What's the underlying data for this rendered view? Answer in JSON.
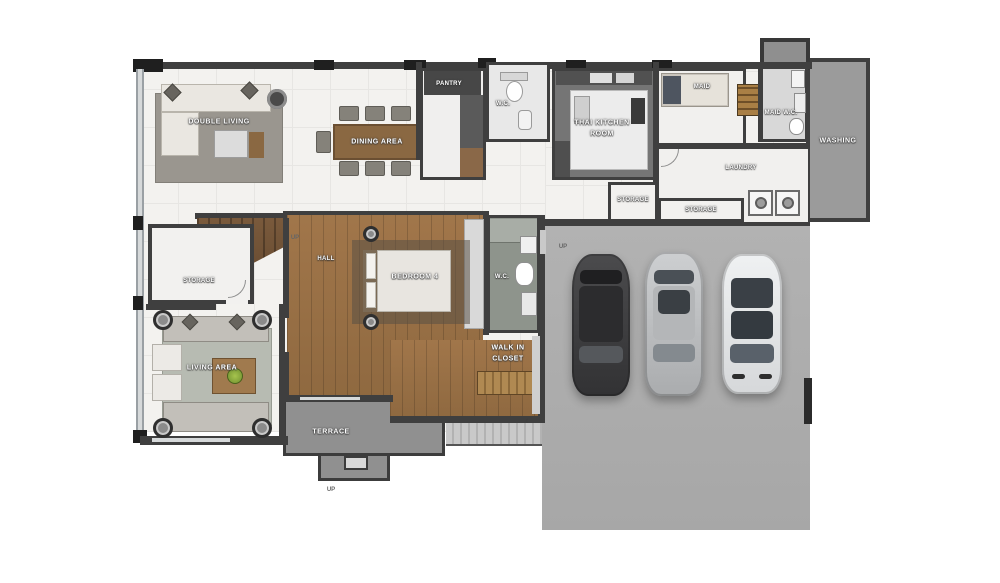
{
  "title": "house-ground-floor-plan",
  "colors": {
    "wall": "#3f3f3f",
    "marble_floor": "#f3f2ef",
    "wood_floor": "#9b7046",
    "stair_wood": "#7a5a3c",
    "garage_concrete": "#acacac",
    "terrace_concrete": "#909090",
    "washing_floor": "#9b9b9b",
    "thai_kitchen_floor": "#757575",
    "label_text": "#ffffff",
    "car_dark": "#3f4042",
    "car_silver": "#c6c8ca",
    "car_white": "#ebedee"
  },
  "rooms": {
    "double_living": {
      "label": "DOUBLE LIVING"
    },
    "dining_area": {
      "label": "DINING AREA"
    },
    "pantry": {
      "label": "PANTRY"
    },
    "wc_top": {
      "label": "W.C."
    },
    "thai_kitchen": {
      "line1": "THAI KITCHEN",
      "line2": "ROOM"
    },
    "maid": {
      "label": "MAID"
    },
    "maid_wc": {
      "label": "MAID W.C."
    },
    "washing": {
      "label": "WASHING"
    },
    "laundry": {
      "label": "LAUNDRY"
    },
    "storage_kitchen": {
      "label": "STORAGE"
    },
    "storage_laundry": {
      "label": "STORAGE"
    },
    "hall": {
      "label": "HALL"
    },
    "storage_hall": {
      "label": "STORAGE"
    },
    "bedroom4": {
      "label": "BEDROOM 4"
    },
    "wc_bedroom": {
      "label": "W.C."
    },
    "walk_in_closet": {
      "line1": "WALK IN",
      "line2": "CLOSET"
    },
    "living_area": {
      "label": "LIVING AREA"
    },
    "terrace": {
      "label": "TERRACE"
    }
  },
  "markers": {
    "up_stairs": "UP",
    "up_garage": "UP",
    "up_terrace": "UP"
  }
}
